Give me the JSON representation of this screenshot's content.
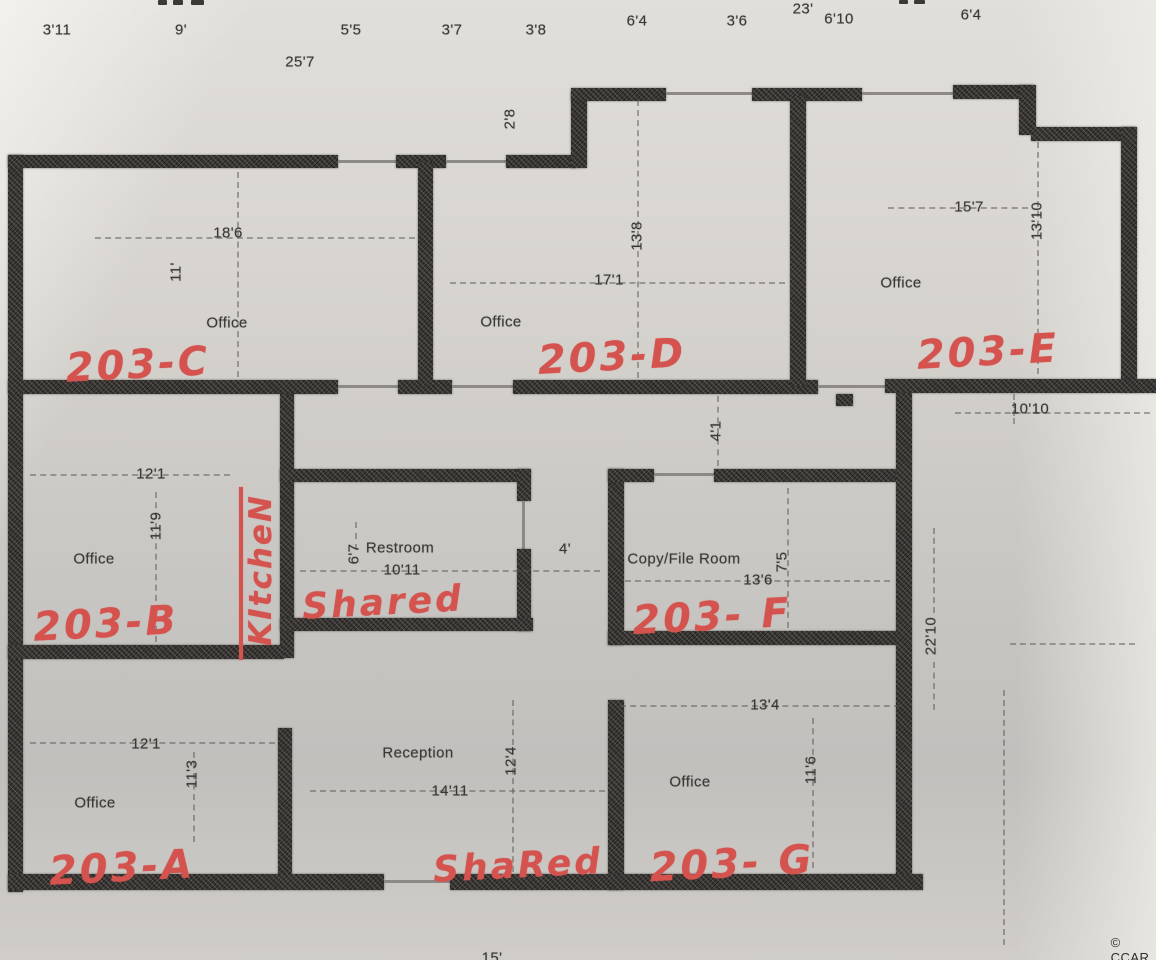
{
  "plan": {
    "top_dims": [
      "3'11",
      "9'",
      "5'5",
      "3'7",
      "3'8",
      "6'4",
      "3'6",
      "23'",
      "6'10",
      "6'4"
    ],
    "overall_width": "25'7",
    "jog_depth": "2'8",
    "hall_width": "4'",
    "rooms": {
      "c": {
        "type": "Office",
        "unit": "203-C",
        "width": "18'6",
        "depth": "11'"
      },
      "d": {
        "type": "Office",
        "unit": "203-D",
        "width": "17'1",
        "depth": "13'8"
      },
      "e": {
        "type": "Office",
        "unit": "203-E",
        "width": "15'7",
        "depth": "13'10"
      },
      "b": {
        "type": "Office",
        "unit": "203-B",
        "width": "12'1",
        "depth": "11'9"
      },
      "kitchen": {
        "annotation": "KItcheN"
      },
      "restroom": {
        "type": "Restroom",
        "width": "10'11",
        "depth": "6'7",
        "annotation": "Shared"
      },
      "f": {
        "type": "Copy/File Room",
        "unit": "203- F",
        "width": "13'6",
        "depth": "7'5",
        "hall_above": "4'1"
      },
      "a": {
        "type": "Office",
        "unit": "203-A",
        "width": "12'1",
        "depth": "11'3"
      },
      "reception": {
        "type": "Reception",
        "width": "14'11",
        "depth": "12'4",
        "annotation": "ShaRed"
      },
      "g": {
        "type": "Office",
        "unit": "203- G",
        "width": "13'4",
        "depth": "11'6"
      }
    },
    "open_area": {
      "width": "10'10",
      "depth": "22'10"
    },
    "bottom_partial_dim": "15'",
    "watermark": "© CCAR"
  },
  "colors": {
    "marker_red": "#d5534e",
    "wall_dark": "#3a3734",
    "paper": "#d7d4cf"
  }
}
